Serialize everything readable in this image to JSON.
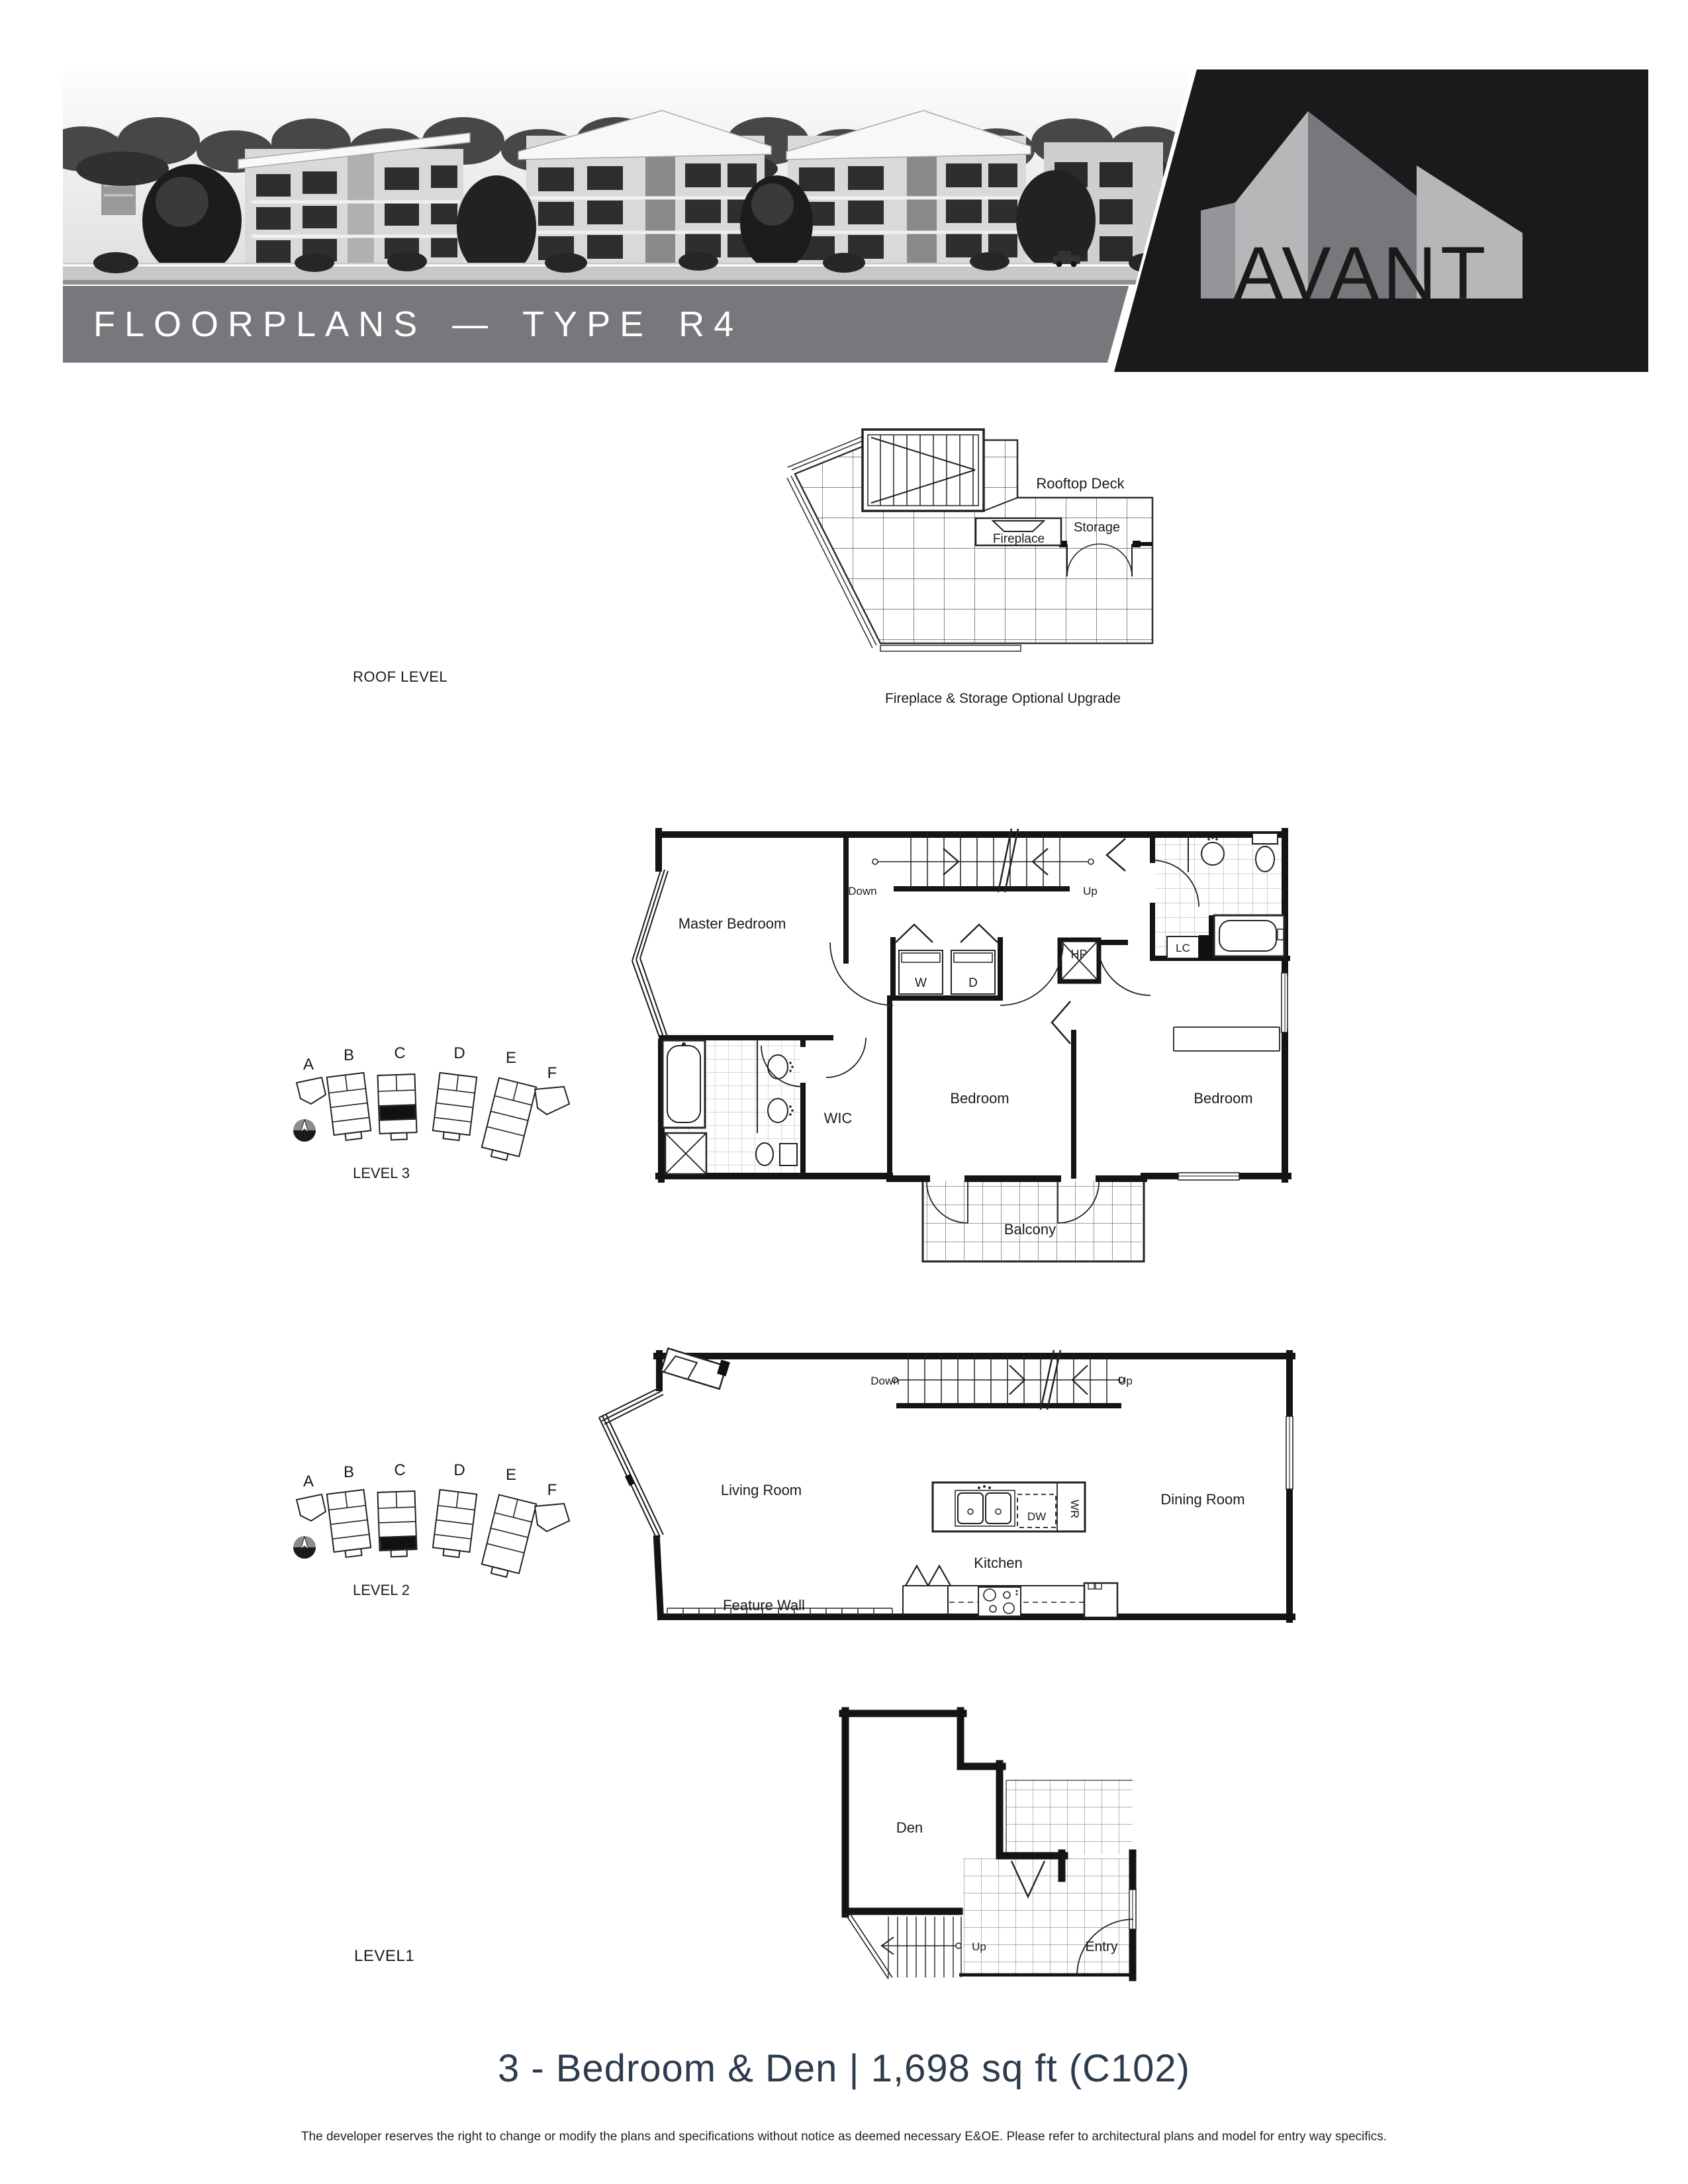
{
  "header": {
    "banner_title": "FLOORPLANS — TYPE R4",
    "brand": {
      "name": "AVANT",
      "tagline": "Lead The Way"
    },
    "colors": {
      "banner_gray": "#77787b",
      "panel_black": "#1c191c",
      "logo_light": "#b5b7b9",
      "logo_mid": "#939598",
      "logo_dark": "#77787b",
      "title_navy": "#2c3b4d"
    }
  },
  "roof": {
    "section_label": "ROOF LEVEL",
    "deck_label": "Rooftop Deck",
    "fireplace_label": "Fireplace",
    "storage_label": "Storage",
    "caption": "Fireplace & Storage Optional Upgrade"
  },
  "level3": {
    "section_label": "LEVEL 3",
    "master_bedroom": "Master Bedroom",
    "wic": "WIC",
    "bedroom_center": "Bedroom",
    "bedroom_right": "Bedroom",
    "balcony": "Balcony",
    "down": "Down",
    "up": "Up",
    "washer": "W",
    "dryer": "D",
    "hp": "HP",
    "lc": "LC"
  },
  "level2": {
    "section_label": "LEVEL 2",
    "living_room": "Living Room",
    "dining_room": "Dining Room",
    "kitchen": "Kitchen",
    "feature_wall": "Feature Wall",
    "down": "Down",
    "up": "Up",
    "dw": "DW",
    "wr": "WR"
  },
  "level1": {
    "section_label": "LEVEL1",
    "den": "Den",
    "entry": "Entry",
    "up": "Up"
  },
  "keyplan": {
    "buildings": [
      "A",
      "B",
      "C",
      "D",
      "E",
      "F"
    ],
    "compass": "N"
  },
  "footer": {
    "unit_title": "3 - Bedroom & Den  |  1,698 sq ft (C102)",
    "disclaimer": "The developer reserves the right to change or modify the plans and specifications without notice as deemed necessary E&OE.  Please refer to architectural plans and model for entry way specifics."
  }
}
